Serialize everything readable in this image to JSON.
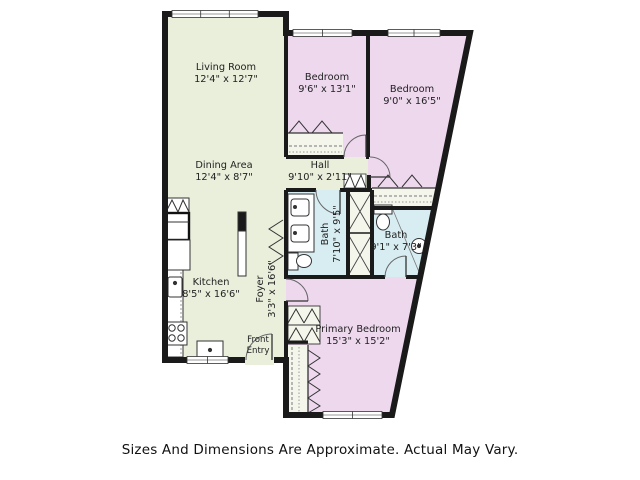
{
  "page": {
    "background": "#ffffff"
  },
  "colors": {
    "living_area_fill": "#e9efdb",
    "bedroom_fill": "#eed8ee",
    "bath_fill": "#d8edf2",
    "closet_fill": "#f4f6ec",
    "wall": "#1a1a1a",
    "label_text": "#222222",
    "disclaimer_text": "#111111"
  },
  "rooms": [
    {
      "name": "Living Room",
      "dims": "12'4\" x 12'7\""
    },
    {
      "name": "Bedroom",
      "dims": "9'6\" x 13'1\""
    },
    {
      "name": "Bedroom",
      "dims": "9'0\" x 16'5\""
    },
    {
      "name": "Dining Area",
      "dims": "12'4\" x 8'7\""
    },
    {
      "name": "Hall",
      "dims": "9'10\" x 2'11\""
    },
    {
      "name": "Bath",
      "dims": "7'10\" x 9'5\""
    },
    {
      "name": "Bath",
      "dims": "9'1\" x 7'3\""
    },
    {
      "name": "Kitchen",
      "dims": "8'5\" x 16'6\""
    },
    {
      "name": "Foyer",
      "dims": "3'3\" x 16'6\""
    },
    {
      "name": "Primary Bedroom",
      "dims": "15'3\" x 15'2\""
    }
  ],
  "entry": {
    "line1": "Front",
    "line2": "Entry"
  },
  "footer": {
    "disclaimer": "Sizes And Dimensions Are Approximate. Actual May Vary."
  }
}
